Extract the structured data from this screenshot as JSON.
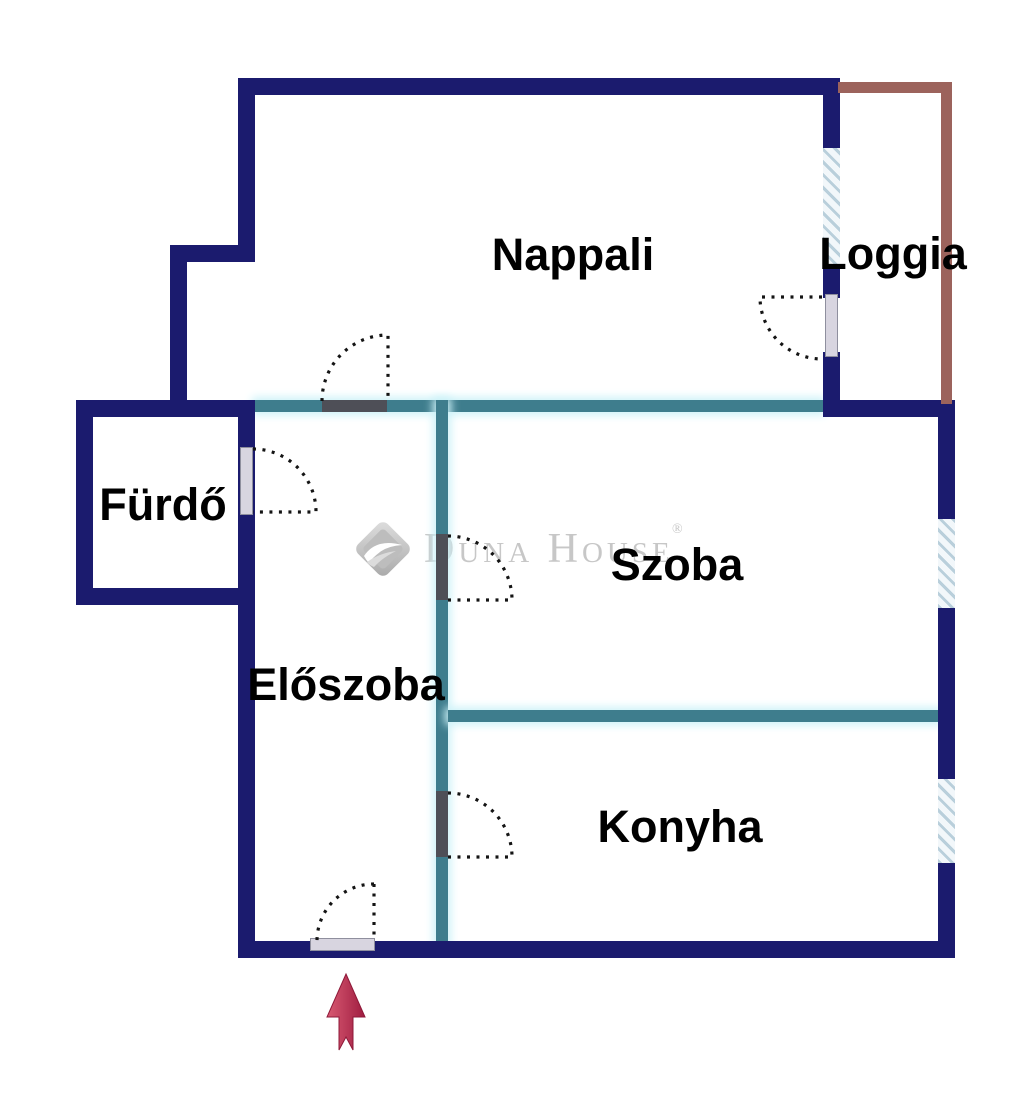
{
  "floorplan": {
    "rooms": [
      {
        "id": "nappali",
        "label": "Nappali"
      },
      {
        "id": "loggia",
        "label": "Loggia"
      },
      {
        "id": "furdo",
        "label": "Fürdő"
      },
      {
        "id": "eloszoba",
        "label": "Előszoba"
      },
      {
        "id": "szoba",
        "label": "Szoba"
      },
      {
        "id": "konyha",
        "label": "Konyha"
      }
    ],
    "watermark": {
      "brand": "Duna House",
      "registered": "®"
    },
    "colors": {
      "wall": "#1b1b6e",
      "partition": "#3e7d8d",
      "partition_glow": "#cdf2f8",
      "loggia_outline": "#9c635c",
      "window_hatch": "#b9cfdb",
      "window_hatch_bg": "#f2f7fa",
      "door_panel_light": "#d8d5e0",
      "door_panel_dark": "#4e4f57",
      "door_arc": "#141414",
      "arrow_start": "#d85a72",
      "arrow_end": "#9f1c40",
      "label_color": "#000000",
      "watermark_gray": "#c7c7c7"
    }
  }
}
